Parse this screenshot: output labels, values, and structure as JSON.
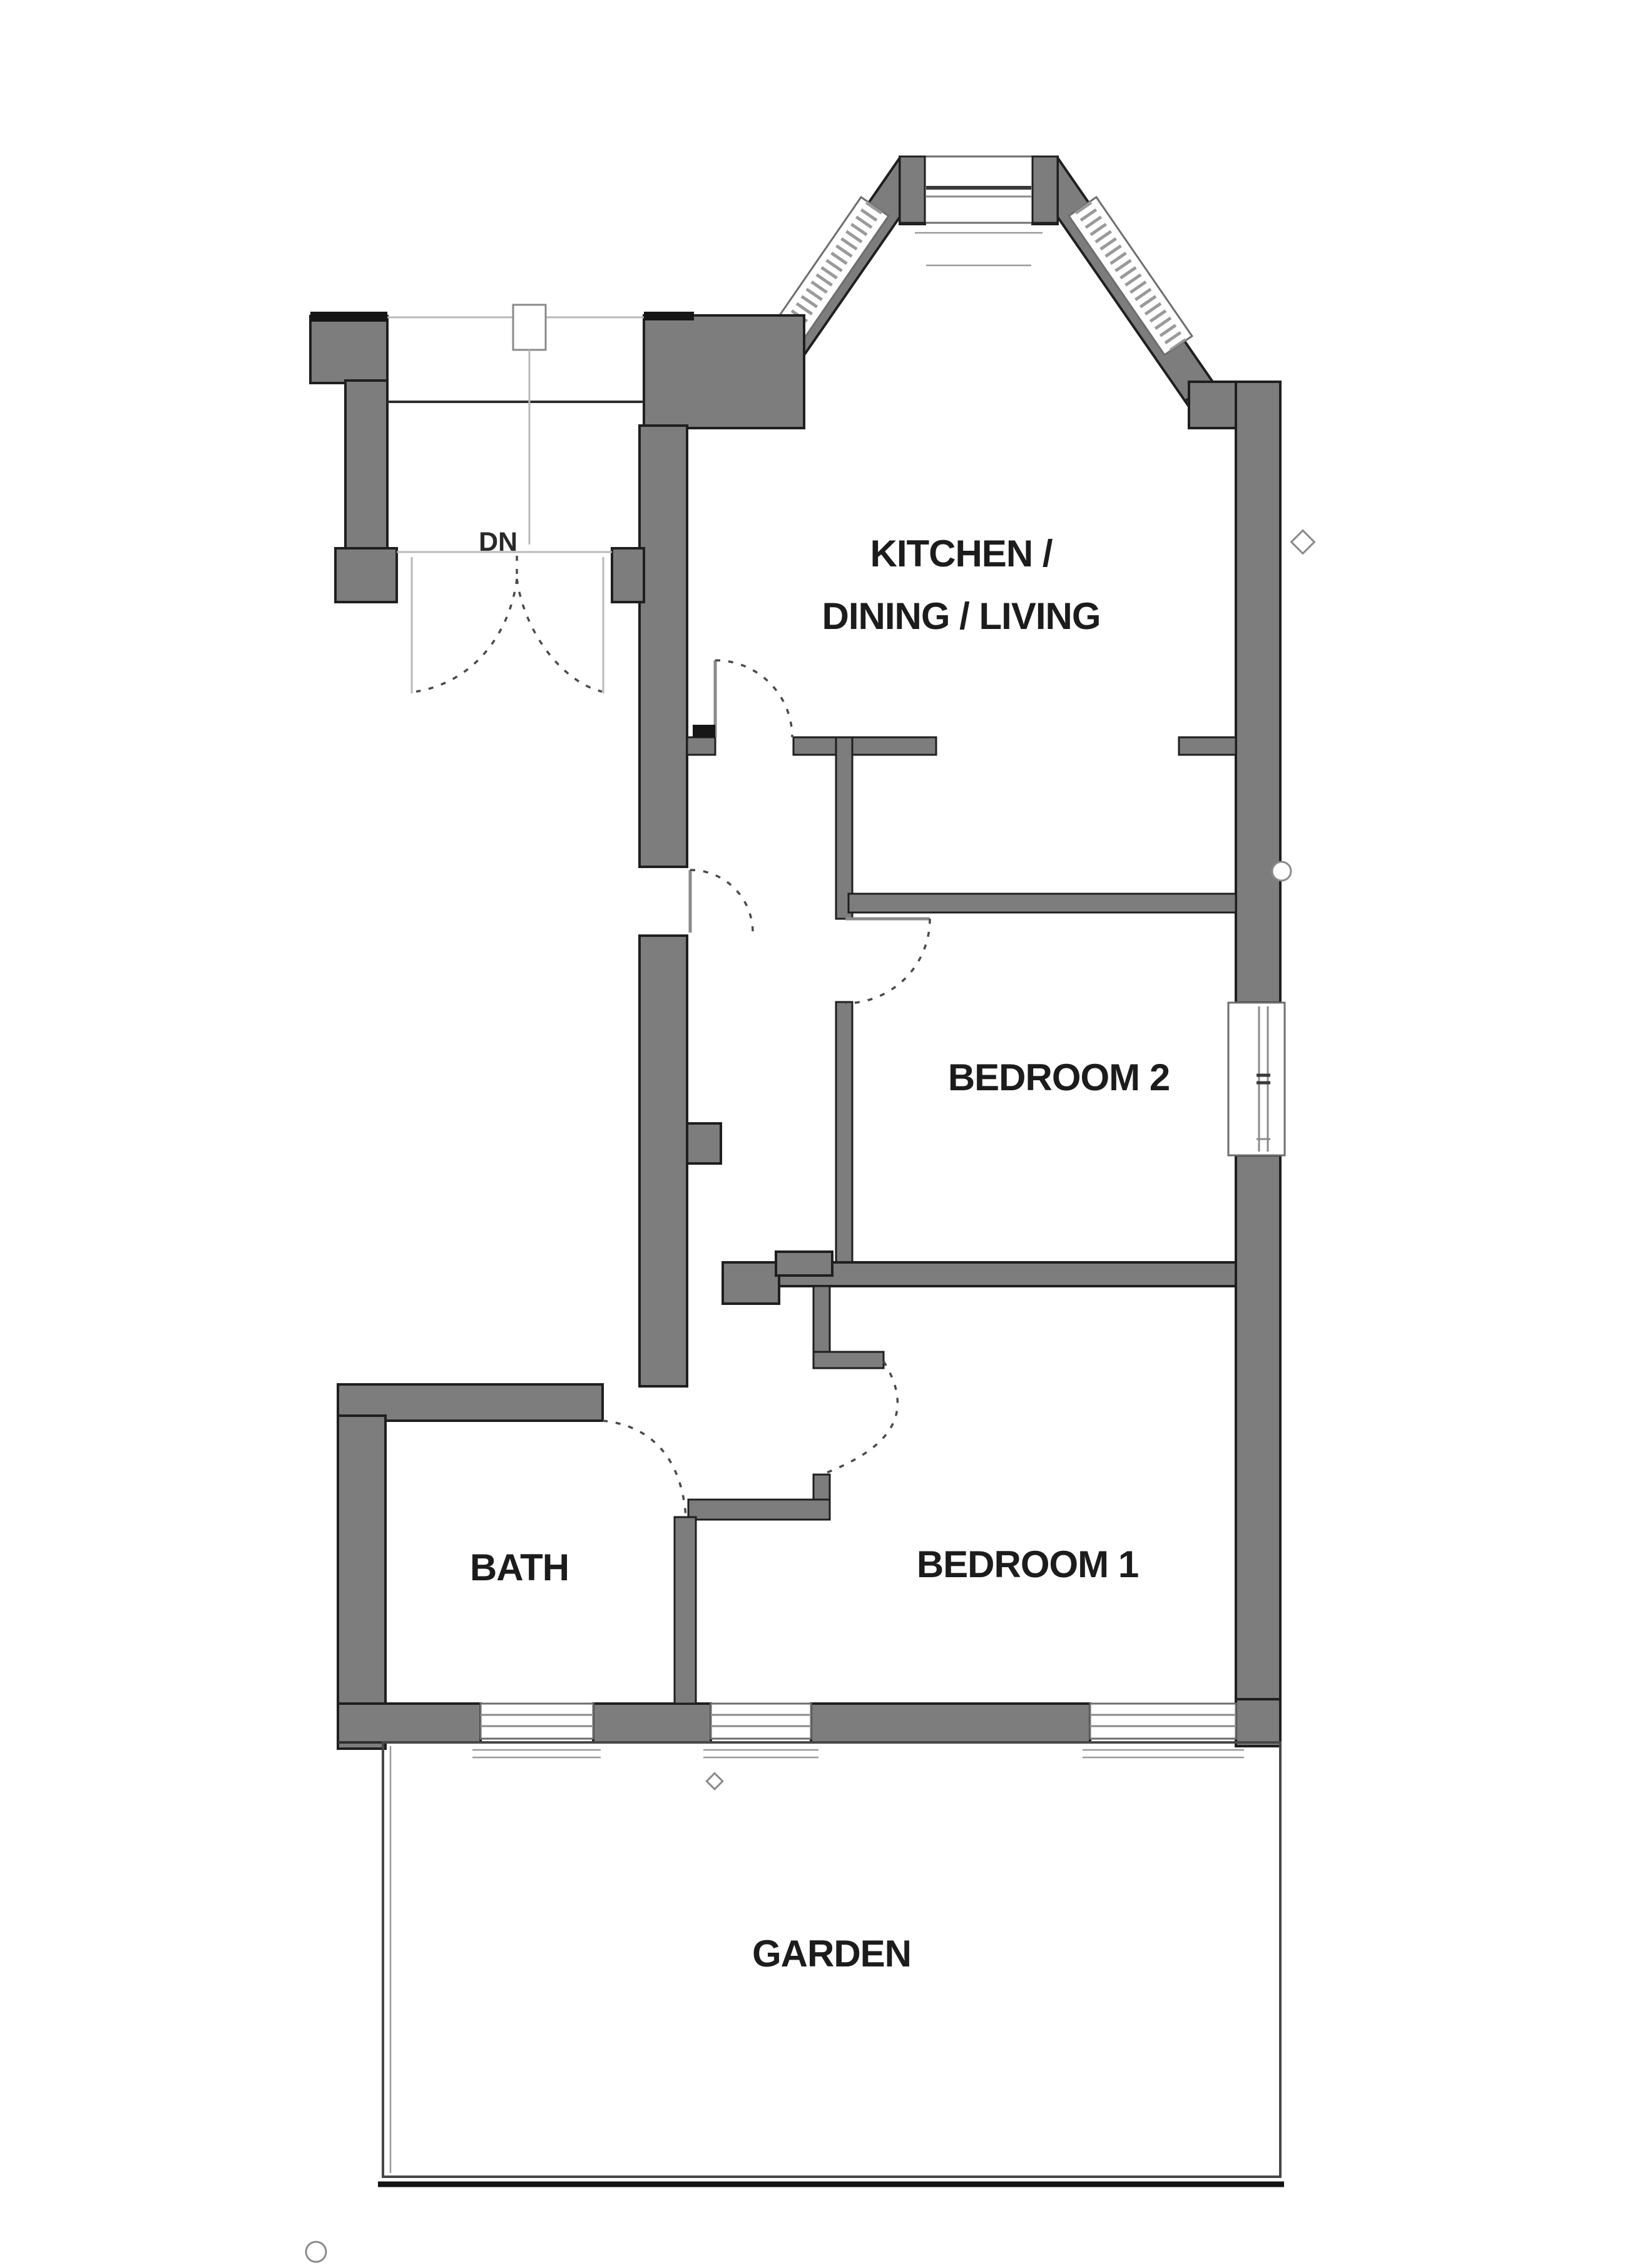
{
  "plan": {
    "type": "residential-floor-plan",
    "rooms": [
      {
        "id": "kitchen-dining-living",
        "label_line1": "KITCHEN /",
        "label_line2": "DINING / LIVING"
      },
      {
        "id": "bedroom-2",
        "label": "BEDROOM 2"
      },
      {
        "id": "bedroom-1",
        "label": "BEDROOM 1"
      },
      {
        "id": "bath",
        "label": "BATH"
      },
      {
        "id": "garden",
        "label": "GARDEN"
      }
    ],
    "stairs": {
      "label": "DN"
    },
    "features": [
      "bay-window",
      "double-entry-door",
      "stairs-down",
      "garden-boundary",
      "bedroom2-side-window",
      "three-rear-windows"
    ],
    "colors": {
      "wall": "#7d7d7d",
      "wall_outline": "#1f1f1f",
      "door_arc": "#4a4a4a",
      "background": "#ffffff",
      "label_text": "#1c1c1c"
    }
  }
}
